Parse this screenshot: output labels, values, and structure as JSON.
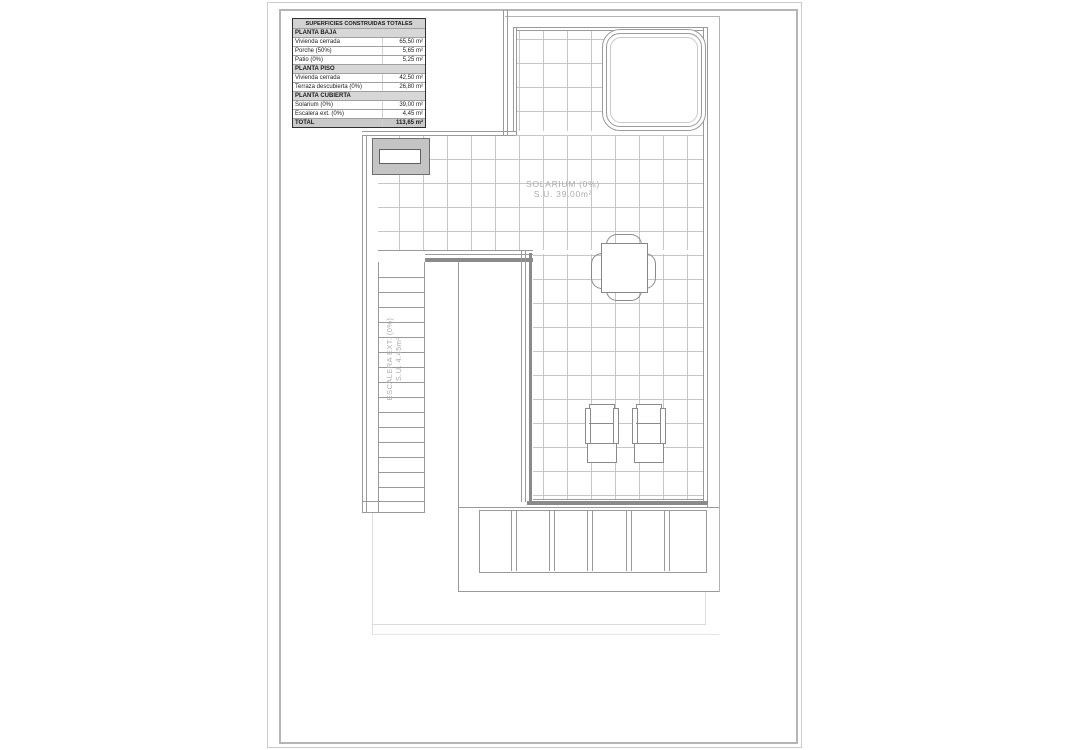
{
  "sheet": {
    "description": "architectural roof plan sheet, planta cubierta"
  },
  "areas_table": {
    "title": "SUPERFICIES CONSTRUIDAS TOTALES",
    "sections": [
      {
        "header": "PLANTA BAJA",
        "rows": [
          {
            "label": "Vivienda cerrada",
            "value": "65,50 m²"
          },
          {
            "label": "Porche (50%)",
            "value": "5,65 m²"
          },
          {
            "label": "Patio (0%)",
            "value": "5,25 m²"
          }
        ]
      },
      {
        "header": "PLANTA PISO",
        "rows": [
          {
            "label": "Vivienda cerrada",
            "value": "42,50 m²"
          },
          {
            "label": "Terraza descubierta (0%)",
            "value": "26,80 m²"
          }
        ]
      },
      {
        "header": "PLANTA CUBIERTA",
        "rows": [
          {
            "label": "Solarium (0%)",
            "value": "39,00 m²"
          },
          {
            "label": "Escalera ext. (0%)",
            "value": "4,45 m²"
          }
        ]
      }
    ],
    "total": {
      "label": "TOTAL",
      "value": "113,65 m²"
    }
  },
  "plan_labels": {
    "solarium": {
      "line1": "SOLARIUM (0%)",
      "line2": "S.U. 39.00m²"
    },
    "stairs": {
      "line1": "ESCALERA EXT. (0%)",
      "line2": "S.U. 4.45m²"
    }
  },
  "colors": {
    "wall_line": "#9a9a9a",
    "thick_wall": "#8a8a8a",
    "grid_line": "#c6c6c6",
    "context_line": "#b3b3b3",
    "faint_boundary": "#dcdcdc",
    "chimney_fill": "#c4c4c4",
    "table_header_bg": "#d2d2d2",
    "label_text": "#acacac",
    "table_text": "#1c1c1c"
  }
}
